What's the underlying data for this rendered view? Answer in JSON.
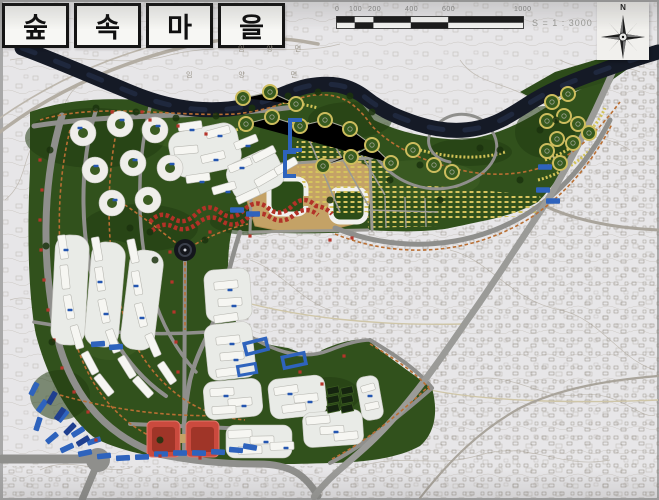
{
  "title": {
    "full": "숲속마을",
    "chars": [
      "숲",
      "속",
      "마",
      "을"
    ]
  },
  "scale_bar": {
    "tick_labels": [
      "0",
      "100",
      "200",
      "400",
      "600",
      "1000"
    ],
    "scale_text": "S = 1 : 3000"
  },
  "compass": {
    "north_label": "N"
  },
  "map": {
    "region_labels": [
      {
        "text": "임 양 면"
      },
      {
        "text": "임 양 면"
      }
    ]
  },
  "legend_colors": {
    "river": "#151a26",
    "site_green": "#31511c",
    "park_dark_green": "#223c12",
    "road_gray": "#8f8f8c",
    "building_white": "#f0efeb",
    "commercial_red": "#c2463a",
    "school_blue": "#2e63bd",
    "garden_plot_yellow": "#d6c45e",
    "plaza_tan": "#c4a266",
    "trail_orange": "#b96f33",
    "parking_navy": "#1f3f8f",
    "cadastral_paper": "#e7e6e8"
  }
}
